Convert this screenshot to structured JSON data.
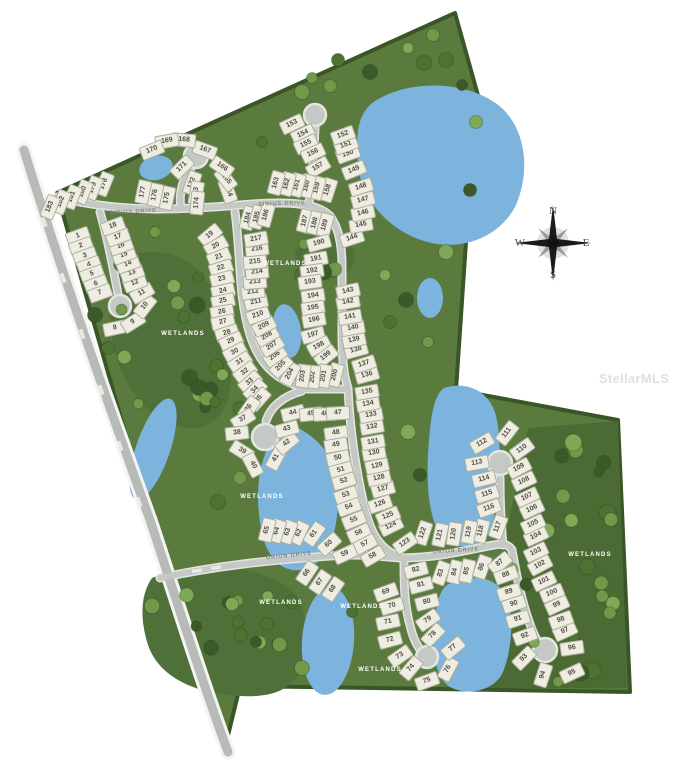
{
  "map_title": "Residential lot site plan",
  "compass": {
    "north": "N",
    "south": "S",
    "east": "E",
    "west": "W"
  },
  "watermark": "StellarMLS",
  "colors": {
    "site_green": "#5b7a3e",
    "wetland_green": "#50703a",
    "forest_green": "#4c6a33",
    "pond_blue": "#7cb4de",
    "road_gray": "#c5c9c6",
    "boundary_green": "#3a5526",
    "lot_fill": "#efece1"
  },
  "road_labels": [
    {
      "text": "SIRIUS DRIVE",
      "x": 133,
      "y": 212,
      "rot": -3
    },
    {
      "text": "SIRIUS DRIVE",
      "x": 282,
      "y": 204,
      "rot": -2
    },
    {
      "text": "ORION DRIVE",
      "x": 289,
      "y": 556,
      "rot": -6
    },
    {
      "text": "ORION DRIVE",
      "x": 456,
      "y": 551,
      "rot": -4
    }
  ],
  "wetland_labels": [
    {
      "text": "WETLANDS",
      "x": 183,
      "y": 334
    },
    {
      "text": "WETLANDS",
      "x": 285,
      "y": 264
    },
    {
      "text": "WETLANDS",
      "x": 262,
      "y": 497
    },
    {
      "text": "WETLANDS",
      "x": 281,
      "y": 603
    },
    {
      "text": "WETLANDS",
      "x": 362,
      "y": 607
    },
    {
      "text": "WETLANDS",
      "x": 380,
      "y": 670
    },
    {
      "text": "WETLANDS",
      "x": 590,
      "y": 555
    }
  ],
  "lots": [
    [
      1,
      78,
      236,
      -20
    ],
    [
      2,
      81,
      246,
      -20
    ],
    [
      3,
      85,
      256,
      -20
    ],
    [
      4,
      89,
      265,
      -20
    ],
    [
      5,
      92,
      274,
      -20
    ],
    [
      6,
      96,
      284,
      -20
    ],
    [
      7,
      100,
      293,
      -20
    ],
    [
      8,
      115,
      328,
      -12
    ],
    [
      9,
      133,
      322,
      -32
    ],
    [
      10,
      145,
      306,
      -52
    ],
    [
      11,
      142,
      293,
      -30
    ],
    [
      12,
      135,
      283,
      -20
    ],
    [
      13,
      132,
      273,
      -20
    ],
    [
      14,
      128,
      264,
      -20
    ],
    [
      15,
      124,
      255,
      -20
    ],
    [
      16,
      121,
      246,
      -20
    ],
    [
      17,
      118,
      237,
      -20
    ],
    [
      18,
      113,
      226,
      -20
    ],
    [
      19,
      210,
      235,
      -40
    ],
    [
      20,
      216,
      246,
      -30
    ],
    [
      21,
      219,
      257,
      -22
    ],
    [
      22,
      221,
      268,
      -18
    ],
    [
      23,
      222,
      279,
      -15
    ],
    [
      24,
      223,
      291,
      -13
    ],
    [
      25,
      223,
      301,
      -12
    ],
    [
      26,
      222,
      312,
      -10
    ],
    [
      27,
      223,
      322,
      -12
    ],
    [
      28,
      227,
      333,
      -18
    ],
    [
      29,
      231,
      341,
      -24
    ],
    [
      30,
      235,
      352,
      -28
    ],
    [
      31,
      240,
      362,
      -33
    ],
    [
      32,
      245,
      372,
      -37
    ],
    [
      33,
      250,
      382,
      -41
    ],
    [
      34,
      255,
      390,
      -45
    ],
    [
      35,
      259,
      399,
      -48
    ],
    [
      36,
      249,
      408,
      -55
    ],
    [
      37,
      243,
      419,
      -32
    ],
    [
      38,
      237,
      433,
      -6
    ],
    [
      39,
      242,
      451,
      32
    ],
    [
      40,
      253,
      465,
      62
    ],
    [
      41,
      276,
      458,
      -62
    ],
    [
      42,
      287,
      443,
      -40
    ],
    [
      43,
      287,
      429,
      -15
    ],
    [
      44,
      293,
      413,
      -14
    ],
    [
      45,
      311,
      414,
      -6
    ],
    [
      46,
      325,
      414,
      -3
    ],
    [
      47,
      338,
      413,
      -3
    ],
    [
      48,
      336,
      433,
      -8
    ],
    [
      49,
      336,
      445,
      -10
    ],
    [
      50,
      338,
      458,
      -12
    ],
    [
      51,
      341,
      470,
      -15
    ],
    [
      52,
      344,
      481,
      -17
    ],
    [
      53,
      346,
      495,
      -19
    ],
    [
      54,
      349,
      507,
      -20
    ],
    [
      55,
      354,
      520,
      -22
    ],
    [
      56,
      359,
      533,
      -25
    ],
    [
      57,
      365,
      544,
      -28
    ],
    [
      58,
      373,
      556,
      -30
    ],
    [
      59,
      345,
      554,
      -25
    ],
    [
      60,
      329,
      544,
      -42
    ],
    [
      61,
      314,
      534,
      -55
    ],
    [
      62,
      299,
      533,
      -65
    ],
    [
      63,
      288,
      532,
      -70
    ],
    [
      64,
      277,
      531,
      -73
    ],
    [
      65,
      267,
      530,
      -76
    ],
    [
      66,
      307,
      573,
      -56
    ],
    [
      67,
      320,
      582,
      -56
    ],
    [
      68,
      333,
      589,
      -56
    ],
    [
      69,
      386,
      592,
      -20
    ],
    [
      70,
      392,
      606,
      -16
    ],
    [
      71,
      388,
      622,
      -12
    ],
    [
      72,
      390,
      640,
      -15
    ],
    [
      73,
      400,
      656,
      -35
    ],
    [
      74,
      411,
      668,
      -50
    ],
    [
      75,
      427,
      681,
      -20
    ],
    [
      76,
      448,
      669,
      -62
    ],
    [
      77,
      453,
      648,
      -40
    ],
    [
      78,
      433,
      635,
      -46
    ],
    [
      79,
      428,
      620,
      -35
    ],
    [
      80,
      427,
      602,
      -15
    ],
    [
      81,
      421,
      585,
      -15
    ],
    [
      82,
      416,
      570,
      -15
    ],
    [
      83,
      441,
      573,
      -70
    ],
    [
      84,
      455,
      572,
      -76
    ],
    [
      85,
      467,
      571,
      -78
    ],
    [
      86,
      482,
      567,
      -70
    ],
    [
      87,
      500,
      563,
      -40
    ],
    [
      88,
      506,
      575,
      -20
    ],
    [
      89,
      509,
      592,
      -18
    ],
    [
      90,
      514,
      604,
      -18
    ],
    [
      91,
      518,
      619,
      -18
    ],
    [
      92,
      525,
      636,
      -20
    ],
    [
      93,
      524,
      658,
      -45
    ],
    [
      94,
      543,
      675,
      -72
    ],
    [
      95,
      572,
      673,
      -25
    ],
    [
      96,
      572,
      648,
      -8
    ],
    [
      97,
      565,
      631,
      -25
    ],
    [
      98,
      561,
      620,
      -20
    ],
    [
      99,
      557,
      605,
      -25
    ],
    [
      100,
      552,
      593,
      -22
    ],
    [
      101,
      544,
      581,
      -25
    ],
    [
      102,
      540,
      565,
      -28
    ],
    [
      103,
      536,
      552,
      -25
    ],
    [
      104,
      536,
      536,
      -25
    ],
    [
      105,
      533,
      524,
      -25
    ],
    [
      106,
      532,
      509,
      -25
    ],
    [
      107,
      527,
      497,
      -25
    ],
    [
      108,
      524,
      481,
      -25
    ],
    [
      109,
      519,
      468,
      -28
    ],
    [
      110,
      522,
      449,
      -36
    ],
    [
      111,
      507,
      433,
      -52
    ],
    [
      112,
      482,
      443,
      -30
    ],
    [
      113,
      477,
      463,
      -10
    ],
    [
      114,
      484,
      479,
      -14
    ],
    [
      115,
      487,
      494,
      -17
    ],
    [
      116,
      489,
      508,
      -20
    ],
    [
      117,
      498,
      527,
      -70
    ],
    [
      118,
      481,
      531,
      -76
    ],
    [
      119,
      469,
      532,
      -79
    ],
    [
      120,
      454,
      534,
      -81
    ],
    [
      121,
      440,
      535,
      -78
    ],
    [
      122,
      423,
      533,
      -72
    ],
    [
      123,
      405,
      543,
      -35
    ],
    [
      124,
      391,
      526,
      -26
    ],
    [
      125,
      388,
      516,
      -23
    ],
    [
      126,
      380,
      504,
      -19
    ],
    [
      127,
      383,
      489,
      -15
    ],
    [
      128,
      379,
      478,
      -12
    ],
    [
      129,
      377,
      466,
      -12
    ],
    [
      130,
      374,
      453,
      -10
    ],
    [
      131,
      373,
      442,
      -10
    ],
    [
      132,
      372,
      427,
      -10
    ],
    [
      133,
      371,
      415,
      -10
    ],
    [
      134,
      368,
      404,
      -10
    ],
    [
      135,
      367,
      392,
      -10
    ],
    [
      136,
      367,
      375,
      -15
    ],
    [
      137,
      364,
      364,
      -18
    ],
    [
      138,
      356,
      350,
      -15
    ],
    [
      139,
      354,
      340,
      -12
    ],
    [
      140,
      353,
      328,
      -10
    ],
    [
      141,
      350,
      317,
      -10
    ],
    [
      142,
      348,
      302,
      -10
    ],
    [
      143,
      348,
      291,
      -12
    ],
    [
      144,
      352,
      238,
      -18
    ],
    [
      145,
      361,
      225,
      -10
    ],
    [
      146,
      363,
      213,
      -12
    ],
    [
      147,
      363,
      200,
      -15
    ],
    [
      148,
      361,
      187,
      -18
    ],
    [
      149,
      354,
      170,
      -22
    ],
    [
      150,
      348,
      154,
      -20
    ],
    [
      151,
      346,
      145,
      -20
    ],
    [
      152,
      343,
      135,
      -20
    ],
    [
      153,
      292,
      124,
      -25
    ],
    [
      154,
      303,
      134,
      -25
    ],
    [
      155,
      306,
      144,
      -25
    ],
    [
      156,
      313,
      153,
      -25
    ],
    [
      157,
      318,
      167,
      -30
    ],
    [
      158,
      328,
      190,
      -72
    ],
    [
      159,
      317,
      188,
      -75
    ],
    [
      160,
      307,
      186,
      -75
    ],
    [
      161,
      297,
      185,
      -75
    ],
    [
      162,
      287,
      184,
      -75
    ],
    [
      163,
      276,
      183,
      -75
    ],
    [
      164,
      228,
      191,
      70
    ],
    [
      165,
      226,
      179,
      52
    ],
    [
      166,
      222,
      167,
      35
    ],
    [
      167,
      205,
      150,
      20
    ],
    [
      168,
      184,
      140,
      5
    ],
    [
      169,
      167,
      141,
      -10
    ],
    [
      170,
      152,
      150,
      -22
    ],
    [
      171,
      182,
      167,
      -45
    ],
    [
      172,
      192,
      183,
      -70
    ],
    [
      173,
      196,
      193,
      -80
    ],
    [
      174,
      197,
      203,
      -85
    ],
    [
      175,
      167,
      198,
      -78
    ],
    [
      176,
      155,
      195,
      -78
    ],
    [
      177,
      143,
      192,
      -78
    ],
    [
      178,
      104,
      184,
      -68
    ],
    [
      179,
      93,
      188,
      -68
    ],
    [
      180,
      83,
      192,
      -68
    ],
    [
      181,
      72,
      197,
      -68
    ],
    [
      182,
      61,
      202,
      -68
    ],
    [
      183,
      50,
      207,
      -68
    ],
    [
      184,
      248,
      218,
      -75
    ],
    [
      185,
      257,
      217,
      -75
    ],
    [
      186,
      266,
      215,
      -75
    ],
    [
      187,
      305,
      221,
      -75
    ],
    [
      188,
      315,
      223,
      -75
    ],
    [
      189,
      325,
      225,
      -75
    ],
    [
      190,
      319,
      243,
      -15
    ],
    [
      191,
      316,
      259,
      -10
    ],
    [
      192,
      312,
      271,
      -8
    ],
    [
      193,
      310,
      282,
      -8
    ],
    [
      194,
      313,
      296,
      -8
    ],
    [
      195,
      313,
      308,
      -8
    ],
    [
      196,
      314,
      320,
      -10
    ],
    [
      197,
      313,
      335,
      -15
    ],
    [
      198,
      319,
      346,
      -28
    ],
    [
      199,
      326,
      356,
      -38
    ],
    [
      200,
      335,
      375,
      -75
    ],
    [
      201,
      324,
      376,
      -80
    ],
    [
      202,
      313,
      377,
      -85
    ],
    [
      203,
      303,
      376,
      -82
    ],
    [
      204,
      290,
      374,
      -62
    ],
    [
      205,
      281,
      366,
      -46
    ],
    [
      206,
      275,
      356,
      -35
    ],
    [
      207,
      272,
      346,
      -32
    ],
    [
      208,
      267,
      336,
      -30
    ],
    [
      209,
      264,
      326,
      -28
    ],
    [
      210,
      258,
      315,
      -20
    ],
    [
      211,
      256,
      302,
      -12
    ],
    [
      212,
      253,
      292,
      -8
    ],
    [
      213,
      255,
      282,
      -5
    ],
    [
      214,
      257,
      272,
      -5
    ],
    [
      215,
      255,
      262,
      -5
    ],
    [
      216,
      257,
      249,
      -6
    ],
    [
      217,
      256,
      239,
      -10
    ]
  ]
}
